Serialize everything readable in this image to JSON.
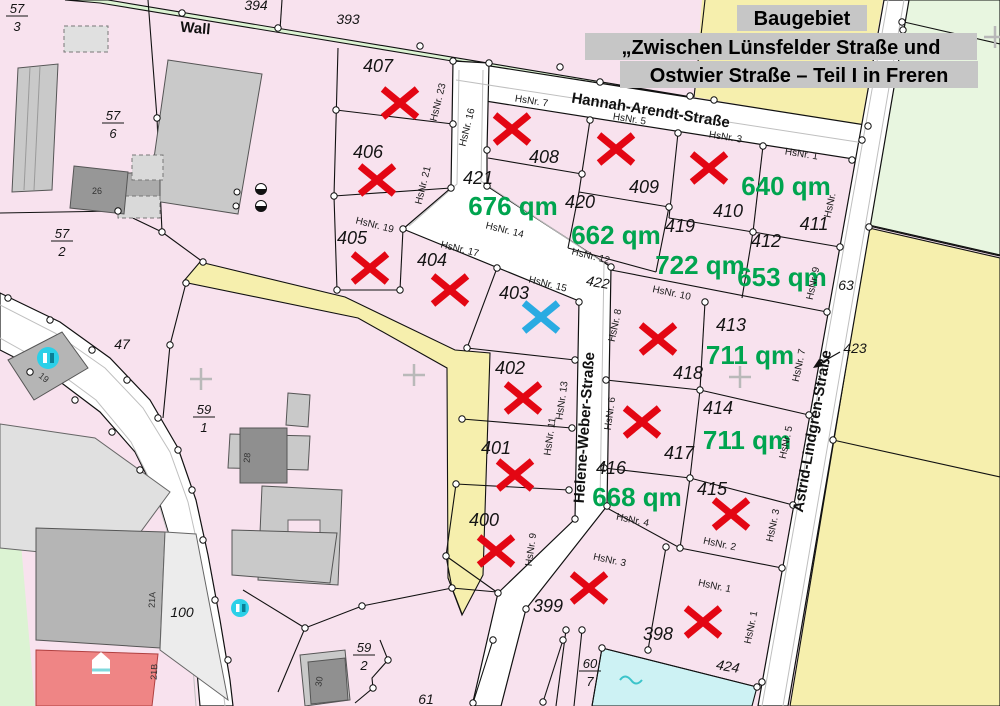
{
  "title": {
    "line1": "Baugebiet",
    "line2": "„Zwischen Lünsfelder Straße und",
    "line3": "Ostwier Straße – Teil I in Freren"
  },
  "streets": {
    "wall": "Wall",
    "hannah": "Hannah-Arendt-Straße",
    "helene": "Helene-Weber-Straße",
    "astrid": "Astrid-Lindgren-Straße"
  },
  "plots": [
    {
      "number": "393"
    },
    {
      "number": "394"
    },
    {
      "number": "398",
      "status": "sold"
    },
    {
      "number": "399",
      "status": "sold"
    },
    {
      "number": "400",
      "status": "sold"
    },
    {
      "number": "401",
      "status": "sold"
    },
    {
      "number": "402",
      "status": "sold"
    },
    {
      "number": "403",
      "status": "reserved"
    },
    {
      "number": "404",
      "status": "sold"
    },
    {
      "number": "405",
      "status": "sold"
    },
    {
      "number": "406",
      "status": "sold"
    },
    {
      "number": "407",
      "status": "sold"
    },
    {
      "number": "408",
      "status": "sold"
    },
    {
      "number": "409",
      "status": "sold"
    },
    {
      "number": "410",
      "status": "sold"
    },
    {
      "number": "411",
      "status": "available",
      "area": "640 qm"
    },
    {
      "number": "412",
      "status": "available",
      "area": "653 qm"
    },
    {
      "number": "413",
      "status": "available",
      "area": "711 qm"
    },
    {
      "number": "414",
      "status": "available",
      "area": "711 qm"
    },
    {
      "number": "415",
      "status": "sold"
    },
    {
      "number": "416",
      "status": "available",
      "area": "668 qm"
    },
    {
      "number": "417",
      "status": "sold"
    },
    {
      "number": "418",
      "status": "sold"
    },
    {
      "number": "419",
      "status": "available",
      "area": "722 qm"
    },
    {
      "number": "420",
      "status": "available",
      "area": "662 qm"
    },
    {
      "number": "421",
      "status": "available",
      "area": "676 qm"
    },
    {
      "number": "422"
    },
    {
      "number": "423"
    },
    {
      "number": "424"
    }
  ],
  "parcels": {
    "p47": "47",
    "p63": "63",
    "p100": "100",
    "p61": "61",
    "f573": {
      "n": "57",
      "d": "3"
    },
    "f576": {
      "n": "57",
      "d": "6"
    },
    "f572": {
      "n": "57",
      "d": "2"
    },
    "f591": {
      "n": "59",
      "d": "1"
    },
    "f592": {
      "n": "59",
      "d": "2"
    },
    "f607": {
      "n": "60",
      "d": "7"
    }
  },
  "house_numbers": {
    "n23": "HsNr. 23",
    "n21": "HsNr. 21",
    "n19": "HsNr. 19",
    "n17": "HsNr. 17",
    "n15": "HsNr. 15",
    "n16": "HsNr. 16",
    "n14": "HsNr. 14",
    "n12": "HsNr. 12",
    "n10": "HsNr. 10",
    "n8": "HsNr. 8",
    "n7a": "HsNr. 7",
    "n5a": "HsNr. 5",
    "n3a": "HsNr. 3",
    "n1a": "HsNr. 1",
    "ncut": "HsNr.",
    "n9b": "HsNr. 9",
    "n7b": "HsNr. 7",
    "n13": "HsNr. 13",
    "n6": "HsNr. 6",
    "n11": "HsNr. 11",
    "n5b": "HsNr. 5",
    "n9a": "HsNr. 9",
    "n4": "HsNr. 4",
    "n2": "HsNr. 2",
    "n3b": "HsNr. 3",
    "n3c": "HsNr. 3",
    "n1b": "HsNr. 1",
    "n1c": "HsNr. 1"
  },
  "buildings": {
    "b19": "19",
    "b26": "26",
    "b28": "28",
    "b21a": "21A",
    "b21b": "21B",
    "b30": "30"
  },
  "colors": {
    "sold_mark": "#e30613",
    "reserved_mark": "#2aabe2",
    "area_label": "#00a44f",
    "plot_fill": "#f8e2ee",
    "field_fill": "#f6efad",
    "green_fill": "#dcf3d3",
    "water_fill": "#cdf2f4"
  }
}
